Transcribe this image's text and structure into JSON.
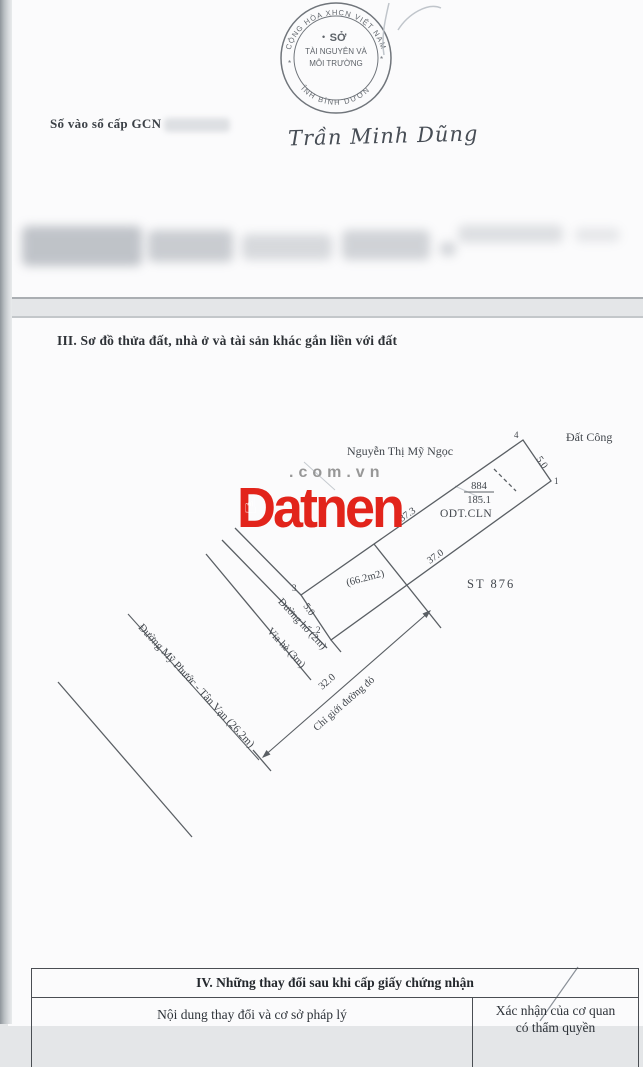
{
  "page1": {
    "stamp": {
      "arc_top": "CỘNG HÒA XHCN VIỆT NAM",
      "arc_bottom": "TỈNH BÌNH DƯƠNG",
      "lines": [
        "SỞ",
        "TÀI NGUYÊN VÀ",
        "MÔI TRƯỜNG"
      ],
      "dot": "•",
      "star_left": "*",
      "star_right": "*"
    },
    "gcn_label": "Số vào sổ cấp GCN",
    "signature": "Trần Minh Dũng"
  },
  "page2": {
    "section3_title": "III. Sơ đồ thửa đất, nhà ở và tài sản khác gắn liền với đất",
    "watermark": {
      "brand": "Datnen",
      "domain": ".com.vn",
      "hand_icon": "☝",
      "brand_color": "#e2241b",
      "domain_color": "#979797"
    },
    "diagram": {
      "owner": "Nguyễn Thị Mỹ Ngọc",
      "public_land": "Đất Công",
      "corner_1": "1",
      "corner_2": "2",
      "corner_3": "3",
      "corner_4": "4",
      "edge_top_right": "5.0",
      "edge_bottom_left": "5.0",
      "edge_upper": "37.3",
      "edge_lower": "37.0",
      "parcel_number": "884",
      "parcel_area": "185.1",
      "land_type": "ODT.CLN",
      "inner_area": "(66.2m2)",
      "map_sheet": "ST 876",
      "alley": "Đường hố (2m)",
      "sidewalk": "Vỉa hè (3m)",
      "road": "Đường Mỹ Phước - Tân Vạn (26.2m)",
      "setback": "32.0",
      "red_line": "Chỉ giới đường đỏ"
    },
    "section4": {
      "title": "IV. Những thay đổi sau khi cấp giấy chứng nhận",
      "col1_header": "Nội dung thay đổi và cơ sở pháp lý",
      "col2_header_line1": "Xác nhận của cơ quan",
      "col2_header_line2": "có thẩm quyền"
    }
  }
}
